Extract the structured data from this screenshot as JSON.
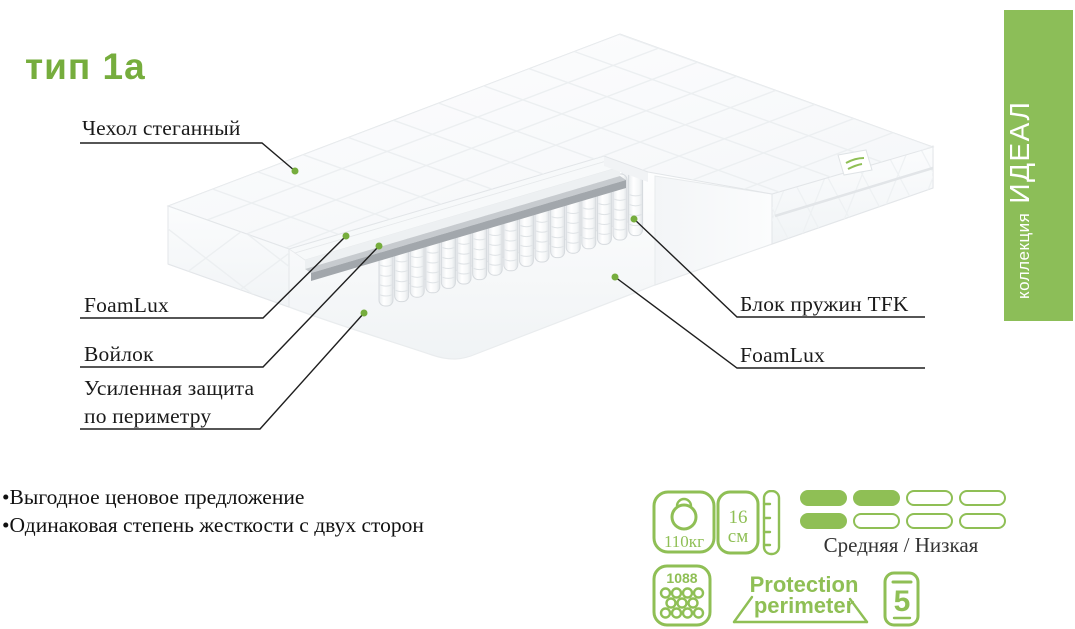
{
  "title": "тип 1а",
  "collection_banner": {
    "prefix": "коллекция",
    "name": "ИДЕАЛ"
  },
  "labels": {
    "cover": "Чехол стеганный",
    "foamlux_left": "FoamLux",
    "felt": "Войлок",
    "perimeter_line1": "Усиленная защита",
    "perimeter_line2": "по периметру",
    "spring_block": "Блок пружин TFK",
    "foamlux_right": "FoamLux"
  },
  "bullets": [
    "•Выгодное ценовое предложение",
    "•Одинаковая степень жесткости с двух сторон"
  ],
  "specs": {
    "max_weight": "110кг",
    "height_value": "16",
    "height_unit": "см",
    "firmness_pattern": [
      [
        1,
        1,
        0,
        0
      ],
      [
        1,
        0,
        0,
        0
      ]
    ],
    "firmness_label": "Средняя / Низкая",
    "springs_count": "1088",
    "protection_line1": "Protection",
    "protection_line2": "perimeter",
    "warranty_years": "5"
  },
  "icons": {
    "weight": "kettlebell-max-weight-icon",
    "height": "mattress-height-ruler-icon",
    "springs": "springs-count-icon",
    "protection": "protection-perimeter-logo",
    "warranty": "warranty-5-years-icon"
  },
  "colors": {
    "accent_green": "#76ad3d",
    "banner_green": "#8cbe58",
    "icon_green": "#8fbf55",
    "label_color": "#1a1a1a"
  }
}
